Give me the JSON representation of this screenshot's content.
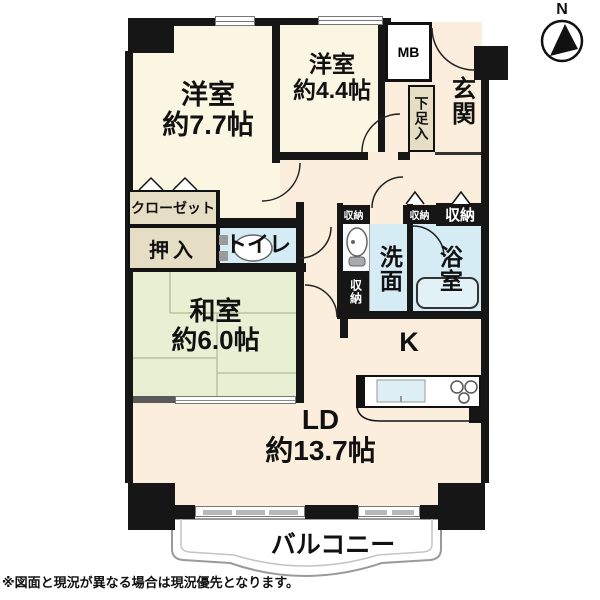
{
  "note": "※図面と現況が異なる場合は現況優先となります。",
  "compass": {
    "label": "N"
  },
  "rooms": {
    "western_1": {
      "name": "洋室",
      "size": "約7.7帖"
    },
    "western_2": {
      "name": "洋室",
      "size": "約4.4帖"
    },
    "japanese": {
      "name": "和室",
      "size": "約6.0帖"
    },
    "living_dining": {
      "name": "LD",
      "size": "約13.7帖"
    },
    "kitchen": {
      "label": "K"
    },
    "entrance": {
      "label": "玄関"
    },
    "toilet": {
      "label": "トイレ"
    },
    "washroom": {
      "label": "洗面"
    },
    "bathroom": {
      "label": "浴室"
    },
    "balcony": {
      "label": "バルコニー"
    }
  },
  "storage": {
    "closet": "クローゼット",
    "futon_closet": "押入",
    "shoe_box": "下足入",
    "meter_box": "MB",
    "storage_label": "収納"
  },
  "colors": {
    "wall": "#161616",
    "western_room": "#fbf6e2",
    "japanese_room": "#e9efd3",
    "wet_room": "#d6ecf4",
    "living_dining": "#fceedd",
    "closet": "#e5ddc4"
  }
}
